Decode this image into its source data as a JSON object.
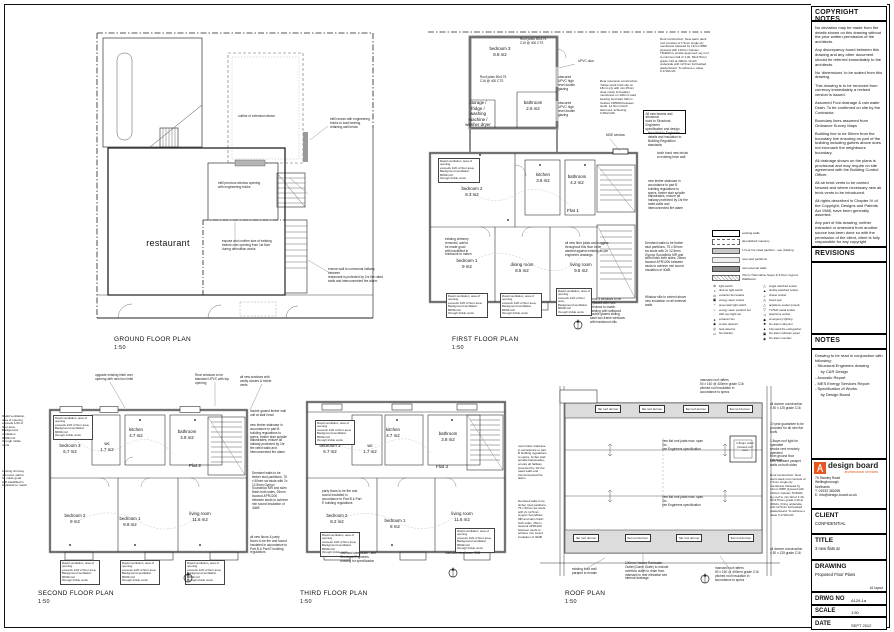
{
  "titleblock": {
    "copyright": {
      "header": "COPYRIGHT NOTES",
      "paragraphs": [
        "No deviation may be made from the details shown on this drawing without the prior written permission of the architects.",
        "Any discrepancy found between this drawing and any other document should be referred immediately to the architects.",
        "No 'dimensions' to be scaled from this drawing.",
        "This drawing is to be removed from currency immediately a revised version is issued.",
        "Assumed Foul drainage & rain water Drain. To be confirmed on site by the Contractor.",
        "Boundary lines assumed from Ordnance Survey Maps",
        "Building line to be 50mm from the boundary line ensuring no part of the building including gutters above does not encroach the neighbours boundary.",
        "All drainage shown on the plans is provisional and may require on site agreement with the Building Control Officer.",
        "All air brick vents to be carried forward and where necessary new air brick vents to be introduced.",
        "All rights described in Chapter IV of the Copyright, Designs and Patents Act 1988, have been generally asserted.",
        "Any part of this drawing, neither extracted or amended from another source has been done so with the permission of the client, client is fully responsible for any copyright infringement."
      ]
    },
    "revisions": {
      "header": "REVISIONS"
    },
    "notes": {
      "header": "NOTES",
      "lines": [
        "Drawing to be read in conjunction with following:",
        "- Structural Engineers drawing",
        "     by C&R Design",
        "- Acoustic Report",
        "- MES Energy Services Report",
        "- Specification of Works",
        "     by Design Board"
      ]
    },
    "firm": {
      "name": "design board",
      "tagline": "architectural services",
      "brand_color": "#e8571f",
      "address": [
        "76 Stanley Road",
        "Wellingborough",
        "Northants",
        "T. 01933 380255",
        "E. info@design-board.co.uk"
      ]
    },
    "client": {
      "label": "CLIENT",
      "value": "CONFIDENTIAL"
    },
    "title": {
      "label": "TITLE",
      "value": "3 new flats at"
    },
    "drawing": {
      "label": "DRAWING",
      "value": "Proposed Floor Plans",
      "layout_note": "A1 layout"
    },
    "drwg_no": {
      "label": "DRWG NO",
      "value": "A129-1a"
    },
    "scale": {
      "label": "SCALE",
      "value": "1:50"
    },
    "date": {
      "label": "DATE",
      "value": "SEPT 2012"
    }
  },
  "legend": {
    "wall_types": [
      {
        "style": "existing",
        "label": "existing walls"
      },
      {
        "style": "demolished",
        "label": "demolished masonry"
      },
      {
        "style": "fire",
        "label": "1 hour fire rated partition - see drawing"
      },
      {
        "style": "stud",
        "label": "new stud partitions"
      },
      {
        "style": "external",
        "label": "new external walls"
      },
      {
        "style": "thermaline",
        "label": "70mm Thermaline Super & 9.5mm Gyproc Wallboard"
      }
    ],
    "symbols_left": [
      {
        "glyph": "⊘",
        "label": "light switch"
      },
      {
        "glyph": "◑",
        "label": "dimmer light switch"
      },
      {
        "glyph": "⊙",
        "label": "extractor fan isolator"
      },
      {
        "glyph": "▣",
        "label": "energy saver socket"
      },
      {
        "glyph": "◔",
        "label": "pneumatic light switch"
      },
      {
        "glyph": "○",
        "label": "energy saver pendant set"
      },
      {
        "glyph": "◌",
        "label": "LED spot light set"
      },
      {
        "glyph": "●",
        "label": "extractor fan"
      },
      {
        "glyph": "◉",
        "label": "smoke detector"
      },
      {
        "glyph": "◎",
        "label": "heat detector"
      },
      {
        "glyph": "▭",
        "label": "fire blanket"
      }
    ],
    "symbols_right": [
      {
        "glyph": "△",
        "label": "single switched socket"
      },
      {
        "glyph": "▲",
        "label": "double switched socket"
      },
      {
        "glyph": "▵",
        "label": "shaver socket"
      },
      {
        "glyph": "◬",
        "label": "fused spur"
      },
      {
        "glyph": "△",
        "label": "appliance socket (noted)"
      },
      {
        "glyph": "▽",
        "label": "TV/SAT aerial socket"
      },
      {
        "glyph": "◁",
        "label": "telephone socket"
      },
      {
        "glyph": "◆",
        "label": "emergency lighting"
      },
      {
        "glyph": "■",
        "label": "fire alarm call point"
      },
      {
        "glyph": "▲",
        "label": "13a rated fire extinguisher"
      },
      {
        "glyph": "▣",
        "label": "fire alarm indicator panel"
      },
      {
        "glyph": "◉",
        "label": "fire alarm sounder"
      }
    ]
  },
  "plans": {
    "ground": {
      "title": "GROUND FLOOR PLAN",
      "scale": "1:50",
      "rooms": {
        "restaurant": "restaurant"
      },
      "ann": {
        "extension": "outline of extension above",
        "infill_recess": "infill recess with engineering\nbricks to load bearing\nretaining wall below",
        "infill_window": "infill previous window opening\nwith engineering bricks",
        "beams": "expose and confirm size of existing\nbeams over opening from 1st floor\nduring demolition works",
        "fire_wall": "ensure wall to communal hallway between\nrestaurant is protected by 1hr fire rated\nwalls and interconnected fire alarm"
      }
    },
    "first": {
      "title": "FIRST FLOOR PLAN",
      "scale": "1:50",
      "rooms": {
        "bedroom3": "bedroom 3\n8.8 m2",
        "storage": "storage /\nfridge /\nwashing\nmachine /\nwasher dryer",
        "bath_top": "bathroom\n2.6 m2",
        "bedroom2": "bedroom 2\n8.3 m2",
        "kitchen": "kitchen\n3.6 m2",
        "bathroom": "bathroom\n4.2 m2",
        "flat": "Flat 1",
        "bedroom1": "bedroom 1\n9 m2",
        "dining": "dining room\n8.5 m2",
        "living": "living room\n9.5 m2"
      },
      "ann": {
        "roof_joists": "Roof joists 50x175\nC16 @ 400 CTS",
        "upvc_door": "UPVC door",
        "obscured": "obscured\nUPVC high\nlevel double\nglazing",
        "moe": "MOE window",
        "roof_constr": "Roof construction: New warm deck roof consists of 1.5mm single ply membrane followed by 12mm WBP plywood with 110mm Celotex TD4000 or similar approved, lay roof to minimum fall of 1:40, 50x175mm grade C16 at 400cts. Finish underside with 12.5mm foil backed plasterboard. To achieve u value 0.17W/m2K",
        "rear_ext": "Rear extension construction: Yellow stock brick slip on 18mm ply with min 25mm clear cavity & breather membrane on 100mm load bearing stud wall, 90mm Celotex FR5000 between studs. 12.5mm finish skimmed, achieving 0.28w/m2K",
        "beams_box": "All new beams and structural\nwork to Structural Engineers\nspecification and design",
        "new_wall": "New Wall to Engineers\ndetails and insulation to\nBuilding Regulation\nstandards",
        "tooth_bond": "tooth bond new bricks\nto existing brick wall",
        "staircase": "new timber staircase in accordance to part B building regulations to specs, timber stair spindle balustrades, ensure all hallway protected by 1hr fire rated walls and interconnected fire alarm",
        "demised": "Demised walls to be timber stud partitions, 75 x 50mm sw studs with 2x 12.5mm Gyproc Soundbloc MR and skim finish both sides, 25mm Isowool APR1200 between studs to achieve min sound insulation of 40dB",
        "sills": "Window sills to extend above\nnew insulation on all external\nwalls",
        "front_windows": "Front 4 windows to be\nreplaced with new\nwindows to match\nexisting with softwood\ndouble glazed sliding\nsash box frame windows\nwith hardwood cills",
        "floor_joists": "all new floor joists and noggins\nthroughout this floor to be\nabutted against existing as per\nengineers drawings",
        "chimney": "existing chimney\nremoved, wall to\nbe made good\nwith backfilled in\nbrickwork to match",
        "rapid_vent": "Rapid ventilation, area of opening\nexceeds 1/20 of floor area,\nBackground ventilation 8000mm2\nthrough trickle vents"
      }
    },
    "second": {
      "title": "SECOND FLOOR PLAN",
      "scale": "1:50",
      "rooms": {
        "bedroom3": "bedroom 3\n6.7 m2",
        "kitchen": "kitchen\n4.7 m2",
        "wc": "wc\n1.7 m2",
        "bathroom": "bathroom\n3.8 m2",
        "flat": "Flat 2",
        "bedroom2": "bedroom 2\n9 m2",
        "bedroom1": "bedroom 1\n9.8 m2",
        "living": "living room\n11.6 m2"
      },
      "ann": {
        "lintel": "upgrade existing lintel over\nopening with new box lintel",
        "rear_windows": "Rear windows to be\nstandard UPVC with top\nopening",
        "new_windows": "all new windows with\ncavity closers & trickle vents",
        "stair_glazed": "double glazed timber wall\nunit at stair head",
        "floors": "all new floors & party floors to be fire and sound insulated in accordance to Part B & Part E building regulations"
      }
    },
    "third": {
      "title": "THIRD FLOOR PLAN",
      "scale": "1:50",
      "rooms": {
        "bedroom3": "bedroom 3\n6.7 m2",
        "kitchen": "kitchen\n4.7 m2",
        "wc": "wc\n1.7 m2",
        "bathroom": "bathroom\n3.8 m2",
        "flat": "Flat 3",
        "bedroom2": "bedroom 2\n8.2 m2",
        "bedroom1": "bedroom 1\n8 m2",
        "living": "living room\n11.6 m2"
      },
      "ann": {
        "party_floors": "party floors to be fire and\nsound insulated in\naccordance to Part B & Part\nE building regulations",
        "mansard_see": "mansard steelbeam - see\nStructural Engineers\ndrawing for specification",
        "mansard_ssb": "mansard steelbeam SSB"
      }
    },
    "roof": {
      "title": "ROOF PLAN",
      "scale": "1:50",
      "dormers_top": [
        "flat roof dormer",
        "flat roof dormer",
        "flat roof dormer",
        "flat roof dormer"
      ],
      "dormers_bottom": [
        "flat roof dormer",
        "flat roof dormer",
        "flat roof dormer",
        "flat roof dormer"
      ],
      "ann": {
        "joist_span": "new flat roof joists max. span 3m -\nsee Engineers specification",
        "velux": "1.8sqm velux\npivoted roof\nvent",
        "rafters": "mansard roof rafters\n50 x 150 @ 400mm grade C16\npitched roof insulation in\naccordance to specs",
        "dormer_constr": "all dormer construction\n4 50 x 125 grade C16",
        "guarantee": "10 year guarantee to be\nprovided for all new flat roofs",
        "rooflight": "1.8sqm roof light for openable\nsmoke vent remotely operated\nfrom ground floor entrance",
        "parapet": "new mansard parapet\nwalls on both sides",
        "roof_constr": "Roof construction: New warm deck roof consists of 1.5mm single ply membrane followed by 12mm WBP plywood with 110mm Celotex TD4000, lay roof to min fall of 1:40, 50x175mm grade C16 at 400cts, firring underside with 12.5mm foil backed plasterboard. To achieve u value 0.17W/m2K",
        "front_parapet": "existing front wall\nparapet to remain",
        "rwo": "100mm Harmer Rainwater\nOutlet (Dome Grate) to include\noverflow outlet to drain from\nmansard to rear elevation see\ninternal drainage"
      }
    }
  }
}
